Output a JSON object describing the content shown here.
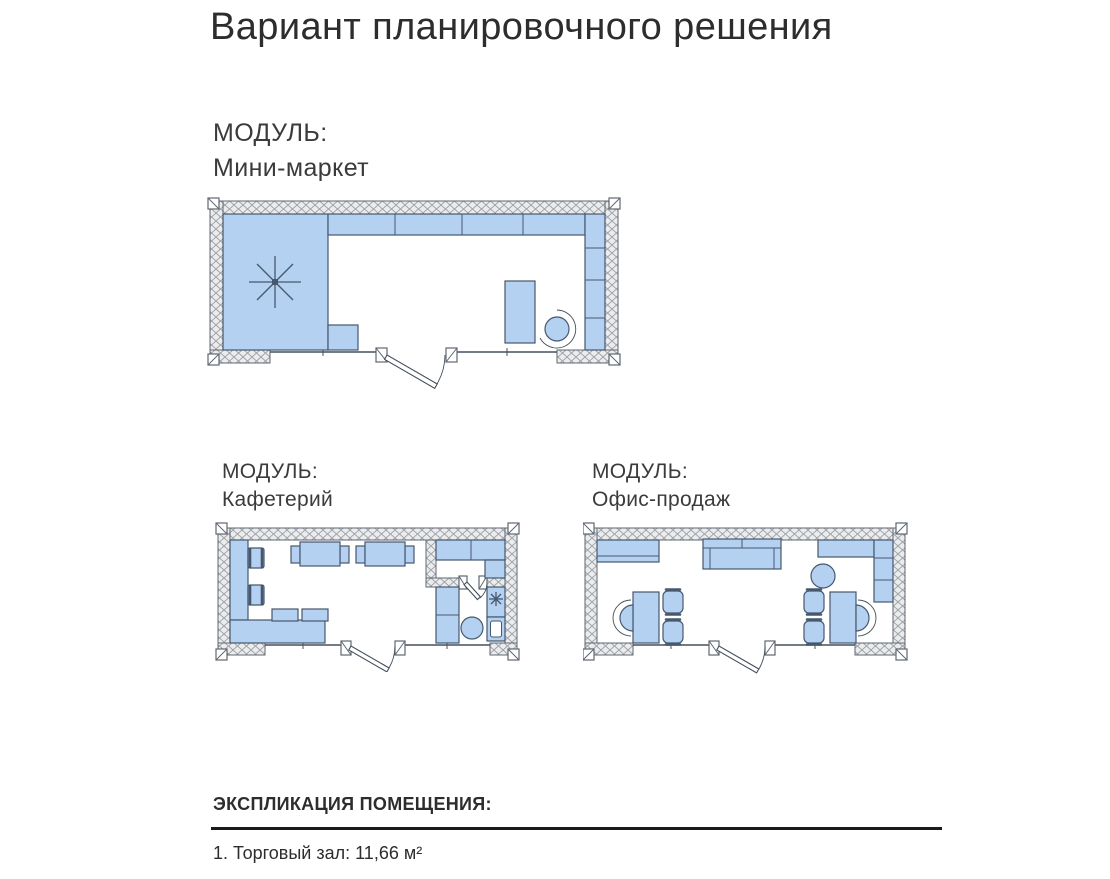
{
  "page": {
    "title": "Вариант планировочного решения"
  },
  "modules": [
    {
      "label": "МОДУЛЬ:",
      "name": "Мини-маркет"
    },
    {
      "label": "МОДУЛЬ:",
      "name": "Кафетерий"
    },
    {
      "label": "МОДУЛЬ:",
      "name": "Офис-продаж"
    }
  ],
  "explication": {
    "heading": "ЭКСПЛИКАЦИЯ ПОМЕЩЕНИЯ:",
    "items": [
      "1. Торговый зал: 11,66 м²"
    ]
  },
  "colors": {
    "plan_fill": "#b5d1f2",
    "plan_stroke": "#46586d",
    "wall_fill": "#ececec",
    "wall_stroke": "#5f6771",
    "hatch_line": "#99a0a9",
    "line": "#45505c",
    "text": "#2d2d2d",
    "rule": "#1b1b1b"
  }
}
